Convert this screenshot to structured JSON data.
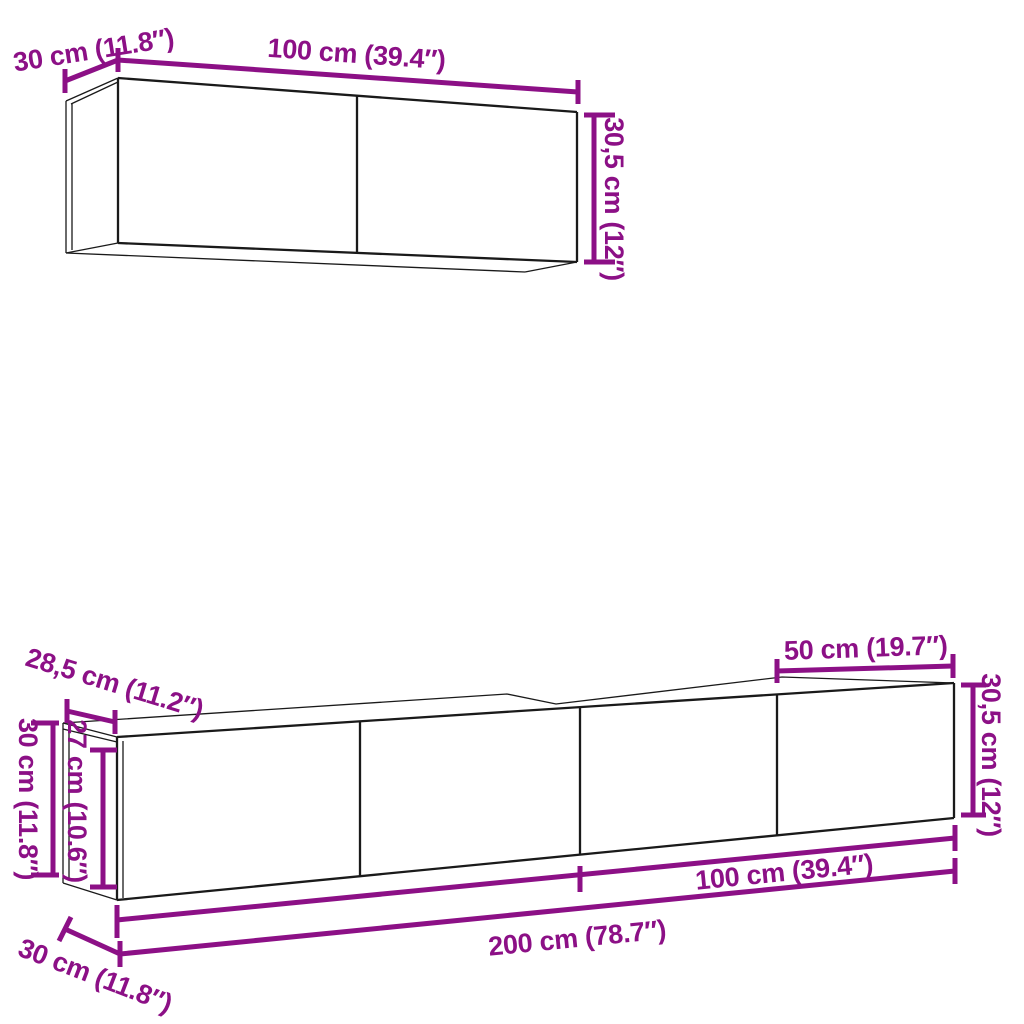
{
  "colors": {
    "background": "#ffffff",
    "outline": "#1a1a1a",
    "dimension": "#8C1086"
  },
  "top_cabinet": {
    "width_label": "100 cm (39.4″)",
    "depth_label": "30 cm (11.8″)",
    "height_label": "30,5 cm (12″)"
  },
  "bottom_unit": {
    "top_depth_label": "28,5 cm (11.2″)",
    "left_height_label": "30 cm (11.8″)",
    "door_height_label": "27 cm (10.6″)",
    "section_width_label": "50 cm (19.7″)",
    "right_height_label": "30,5 cm (12″)",
    "half_width_label": "100 cm (39.4″)",
    "total_width_label": "200 cm (78.7″)",
    "bottom_depth_label": "30 cm (11.8″)"
  }
}
